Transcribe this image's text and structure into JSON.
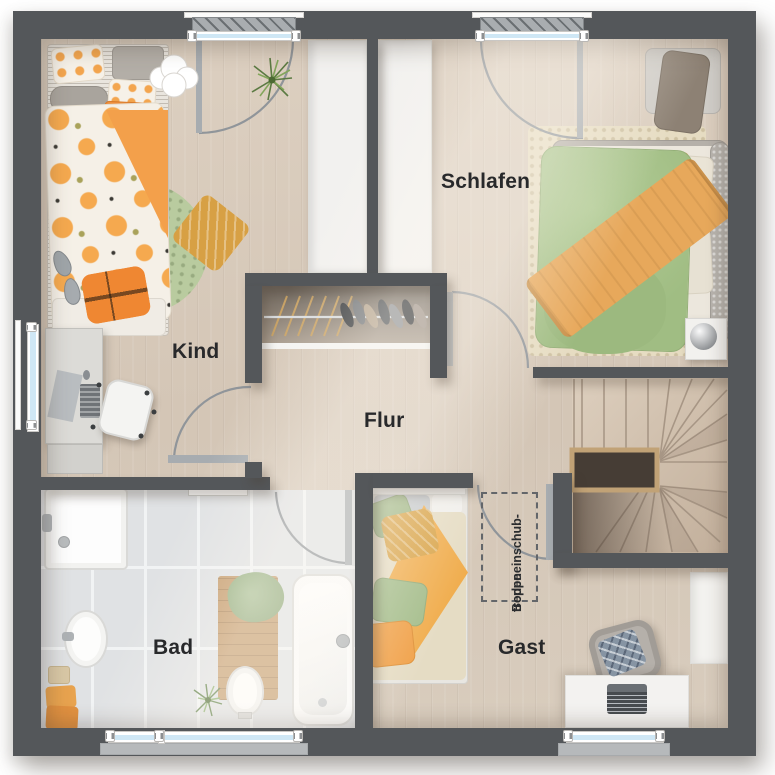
{
  "plan": {
    "title": "Obergeschoss Grundriss",
    "rooms": {
      "kind": {
        "label": "Kind"
      },
      "schlafen": {
        "label": "Schlafen"
      },
      "flur": {
        "label": "Flur"
      },
      "bad": {
        "label": "Bad"
      },
      "gast": {
        "label": "Gast"
      }
    },
    "annotation": {
      "line1": "Bodeneinschub-",
      "line2": "treppe"
    },
    "features": {
      "windows": [
        "kind-north",
        "schlafen-north",
        "kind-west",
        "bad-south",
        "gast-south"
      ],
      "doors": [
        "kind",
        "schlafen",
        "bad",
        "gast"
      ],
      "stairs": "winder-staircase",
      "furniture": [
        "kind-bed",
        "round-rug",
        "desk",
        "office-chair",
        "double-bed",
        "bench",
        "nightstand",
        "shoe-wardrobe",
        "shower",
        "sink",
        "toilet",
        "bathtub",
        "bath-mat",
        "single-bed",
        "armchair",
        "desk-with-laptop",
        "wardrobe"
      ]
    }
  },
  "palette": {
    "wall": "#54575a",
    "wood": "#d8cbbc",
    "tile": "#e0e2e4",
    "glass": "#cfe7f5",
    "green": "#b9cb9f",
    "orange": "#ef8f3a",
    "label": "#28292b",
    "stair": "#d2c3b1"
  }
}
